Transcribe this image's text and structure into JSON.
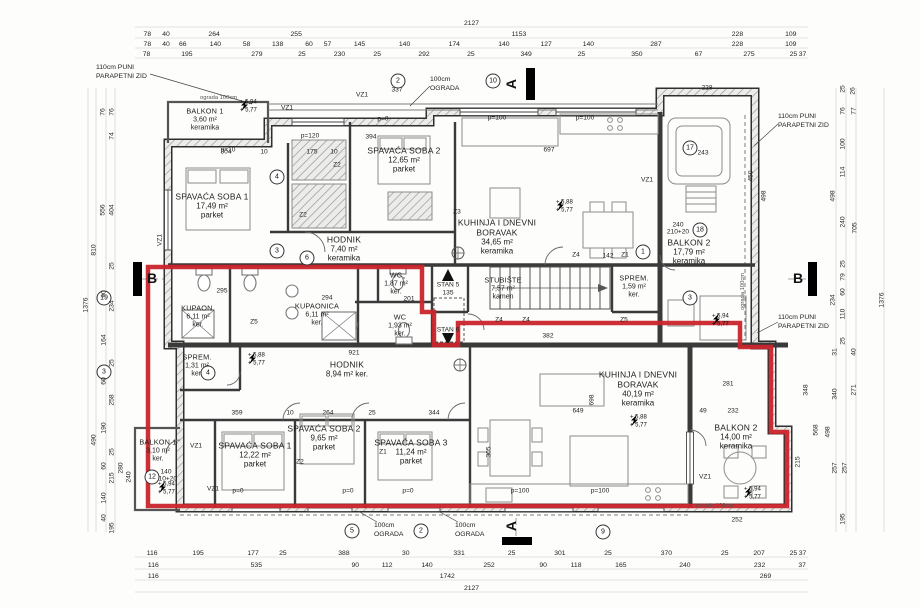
{
  "colors": {
    "boundary_red": "#c9252b",
    "wall": "#2f2f2f",
    "dim_text": "#222222"
  },
  "section_markers": {
    "top": "A",
    "bottom": "A",
    "left": "B",
    "right": "B"
  },
  "rooms": [
    {
      "name": "BALKON 1",
      "area": "3,60 m²",
      "floor": "keramika",
      "x": 205,
      "y": 120,
      "sm": true
    },
    {
      "name": "SPAVAĆA SOBA 1",
      "area": "17,49 m²",
      "floor": "parket",
      "x": 212,
      "y": 206
    },
    {
      "name": "SPAVAĆA SOBA 2",
      "area": "12,65 m²",
      "floor": "parket",
      "x": 404,
      "y": 160
    },
    {
      "name": "HODNIK",
      "area": "7,40 m²",
      "floor": "keramika",
      "x": 344,
      "y": 249
    },
    {
      "name": "KUHINJA I DNEVNI BORAVAK",
      "area": "34,65 m²",
      "floor": "keramika",
      "x": 497,
      "y": 237
    },
    {
      "name": "WC",
      "area": "1,87 m²",
      "floor": "ker.",
      "x": 396,
      "y": 284,
      "sm": true
    },
    {
      "name": "STUBIŠTE",
      "area": "7,57 m²",
      "floor": "kamen",
      "x": 503,
      "y": 289,
      "sm": true
    },
    {
      "name": "SPREM.",
      "area": "1,59 m²",
      "floor": "ker.",
      "x": 634,
      "y": 287,
      "sm": true
    },
    {
      "name": "BALKON 2",
      "area": "17,79 m²",
      "floor": "keramika",
      "x": 689,
      "y": 252
    },
    {
      "name": "KUPAON.",
      "area": "6,11 m²",
      "floor": "ker.",
      "x": 198,
      "y": 317,
      "sm": true
    },
    {
      "name": "KUPAONICA",
      "area": "6,11 m²",
      "floor": "ker.",
      "x": 317,
      "y": 315,
      "sm": true
    },
    {
      "name": "WC",
      "area": "1,93 m²",
      "floor": "ker.",
      "x": 400,
      "y": 326,
      "sm": true
    },
    {
      "name": "SPREM.",
      "area": "1,31 m²",
      "floor": "ker.",
      "x": 197,
      "y": 366,
      "sm": true
    },
    {
      "name": "HODNIK",
      "area": "8,94 m² ker.",
      "floor": "",
      "x": 347,
      "y": 369
    },
    {
      "name": "BALKON 1",
      "area": "3,10 m²",
      "floor": "ker.",
      "x": 158,
      "y": 451,
      "sm": true
    },
    {
      "name": "SPAVAĆA SOBA 1",
      "area": "12,22 m²",
      "floor": "parket",
      "x": 255,
      "y": 455
    },
    {
      "name": "SPAVAĆA SOBA 2",
      "area": "9,65 m²",
      "floor": "parket",
      "x": 324,
      "y": 438
    },
    {
      "name": "SPAVAĆA SOBA 3",
      "area": "11,24 m²",
      "floor": "parket",
      "x": 411,
      "y": 452
    },
    {
      "name": "KUHINJA I DNEVNI BORAVAK",
      "area": "40,19 m²",
      "floor": "keramika",
      "x": 638,
      "y": 389
    },
    {
      "name": "BALKON 2",
      "area": "14,00 m²",
      "floor": "keramika",
      "x": 736,
      "y": 437
    }
  ],
  "levels": [
    {
      "l": "+ 5,94\n+ 5,77",
      "x": 240,
      "y": 107
    },
    {
      "l": "+ 5,88\n+ 5,77",
      "x": 556,
      "y": 207
    },
    {
      "l": "+ 5,94\n+ 5,77",
      "x": 712,
      "y": 321
    },
    {
      "l": "+ 5,88\n+ 5,77",
      "x": 248,
      "y": 360
    },
    {
      "l": "+ 5,88\n+ 5,77",
      "x": 630,
      "y": 422
    },
    {
      "l": "+ 5,94\n+ 5,77",
      "x": 158,
      "y": 489
    },
    {
      "l": "+ 5,94\n+ 5,77",
      "x": 744,
      "y": 494
    }
  ],
  "annotations": [
    {
      "t": "110cm PUNI\nPARAPETNI ZID",
      "x": 96,
      "y": 64
    },
    {
      "t": "110cm PUNI\nPARAPETNI ZID",
      "x": 778,
      "y": 113
    },
    {
      "t": "110cm PUNI\nPARAPETNI ZID",
      "x": 778,
      "y": 314
    },
    {
      "t": "100cm\nOGRADA",
      "x": 430,
      "y": 76
    },
    {
      "t": "100cm\nOGRADA",
      "x": 374,
      "y": 522
    },
    {
      "t": "100cm\nOGRADA",
      "x": 455,
      "y": 522
    },
    {
      "t": "ograda 100cm",
      "x": 200,
      "y": 95,
      "cls": "t"
    },
    {
      "t": "ograda 100cm",
      "x": 696,
      "y": 503,
      "cls": "t"
    },
    {
      "t": "ograda 100cm",
      "x": 740,
      "y": 310,
      "cls": "t r"
    }
  ],
  "plan_labels": [
    {
      "t": "337",
      "x": 397,
      "y": 90
    },
    {
      "t": "304",
      "x": 226,
      "y": 152
    },
    {
      "t": "175",
      "x": 312,
      "y": 152
    },
    {
      "t": "10",
      "x": 264,
      "y": 152
    },
    {
      "t": "10",
      "x": 334,
      "y": 152
    },
    {
      "t": "394",
      "x": 371,
      "y": 137
    },
    {
      "t": "p=120",
      "x": 310,
      "y": 136
    },
    {
      "t": "p=10",
      "x": 228,
      "y": 150
    },
    {
      "t": "p=0",
      "x": 383,
      "y": 119
    },
    {
      "t": "p=100",
      "x": 497,
      "y": 118
    },
    {
      "t": "p=100",
      "x": 585,
      "y": 118
    },
    {
      "t": "697",
      "x": 549,
      "y": 150
    },
    {
      "t": "243",
      "x": 703,
      "y": 153
    },
    {
      "t": "450",
      "x": 751,
      "y": 176,
      "r": true
    },
    {
      "t": "498",
      "x": 764,
      "y": 196,
      "r": true
    },
    {
      "t": "228",
      "x": 707,
      "y": 88
    },
    {
      "t": "295",
      "x": 222,
      "y": 291
    },
    {
      "t": "294",
      "x": 327,
      "y": 298
    },
    {
      "t": "201",
      "x": 409,
      "y": 299
    },
    {
      "t": "921",
      "x": 354,
      "y": 353
    },
    {
      "t": "STAN 5",
      "x": 448,
      "y": 285
    },
    {
      "t": "135",
      "x": 448,
      "y": 293
    },
    {
      "t": "STAN 6",
      "x": 448,
      "y": 330
    },
    {
      "t": "142",
      "x": 608,
      "y": 256
    },
    {
      "t": "382",
      "x": 548,
      "y": 336
    },
    {
      "t": "359",
      "x": 237,
      "y": 413
    },
    {
      "t": "10",
      "x": 290,
      "y": 413
    },
    {
      "t": "264",
      "x": 328,
      "y": 413
    },
    {
      "t": "25",
      "x": 372,
      "y": 413
    },
    {
      "t": "344",
      "x": 434,
      "y": 413
    },
    {
      "t": "649",
      "x": 578,
      "y": 411
    },
    {
      "t": "698",
      "x": 592,
      "y": 400,
      "r": true
    },
    {
      "t": "305",
      "x": 489,
      "y": 452,
      "r": true
    },
    {
      "t": "232",
      "x": 733,
      "y": 411
    },
    {
      "t": "49",
      "x": 703,
      "y": 411
    },
    {
      "t": "281",
      "x": 728,
      "y": 384
    },
    {
      "t": "252",
      "x": 737,
      "y": 520
    },
    {
      "t": "p=0",
      "x": 238,
      "y": 491
    },
    {
      "t": "p=0",
      "x": 348,
      "y": 491
    },
    {
      "t": "p=0",
      "x": 408,
      "y": 491
    },
    {
      "t": "p=100",
      "x": 520,
      "y": 491
    },
    {
      "t": "p=100",
      "x": 600,
      "y": 491
    },
    {
      "t": "240",
      "x": 678,
      "y": 225
    },
    {
      "t": "210+20",
      "x": 678,
      "y": 232
    },
    {
      "t": "140",
      "x": 166,
      "y": 472
    },
    {
      "t": "210+20",
      "x": 166,
      "y": 479
    },
    {
      "t": "VZ1",
      "x": 362,
      "y": 95
    },
    {
      "t": "VZ1",
      "x": 287,
      "y": 108
    },
    {
      "t": "VZ1",
      "x": 647,
      "y": 180
    },
    {
      "t": "VZ1",
      "x": 196,
      "y": 446
    },
    {
      "t": "VZ1",
      "x": 213,
      "y": 489
    },
    {
      "t": "VZ1",
      "x": 705,
      "y": 477
    },
    {
      "t": "VZ1",
      "x": 160,
      "y": 240,
      "r": true
    },
    {
      "t": "Z2",
      "x": 337,
      "y": 165
    },
    {
      "t": "Z2",
      "x": 303,
      "y": 215
    },
    {
      "t": "Z3",
      "x": 457,
      "y": 212
    },
    {
      "t": "Z1",
      "x": 625,
      "y": 255
    },
    {
      "t": "Z4",
      "x": 576,
      "y": 255
    },
    {
      "t": "Z4",
      "x": 499,
      "y": 320
    },
    {
      "t": "Z4",
      "x": 526,
      "y": 320
    },
    {
      "t": "Z5",
      "x": 624,
      "y": 320
    },
    {
      "t": "Z5",
      "x": 254,
      "y": 322
    },
    {
      "t": "Z2",
      "x": 300,
      "y": 462
    },
    {
      "t": "Z1",
      "x": 383,
      "y": 452
    }
  ],
  "circles": [
    {
      "n": "4",
      "x": 277,
      "y": 177
    },
    {
      "n": "3",
      "x": 277,
      "y": 251
    },
    {
      "n": "6",
      "x": 307,
      "y": 258
    },
    {
      "n": "2",
      "x": 398,
      "y": 81
    },
    {
      "n": "10",
      "x": 493,
      "y": 81
    },
    {
      "n": "17",
      "x": 690,
      "y": 148
    },
    {
      "n": "18",
      "x": 700,
      "y": 230
    },
    {
      "n": "1",
      "x": 643,
      "y": 252
    },
    {
      "n": "3",
      "x": 690,
      "y": 298
    },
    {
      "n": "19",
      "x": 104,
      "y": 298
    },
    {
      "n": "3",
      "x": 104,
      "y": 372
    },
    {
      "n": "4",
      "x": 208,
      "y": 373
    },
    {
      "n": "12",
      "x": 152,
      "y": 477
    },
    {
      "n": "5",
      "x": 352,
      "y": 531
    },
    {
      "n": "2",
      "x": 421,
      "y": 531
    },
    {
      "n": "9",
      "x": 603,
      "y": 532
    }
  ],
  "dims": {
    "top_rows": [
      {
        "y": 24,
        "v": [
          "2127"
        ]
      },
      {
        "y": 35,
        "v": [
          "78",
          "40",
          "264",
          "255",
          "1153",
          "228",
          "109"
        ]
      },
      {
        "y": 45,
        "v": [
          "78",
          "40",
          "66",
          "140",
          "58",
          "138",
          "60",
          "57",
          "145",
          "140",
          "174",
          "140",
          "127",
          "140",
          "287",
          "228",
          "109"
        ]
      },
      {
        "y": 55,
        "v": [
          "78",
          "195",
          "279",
          "25",
          "230",
          "25",
          "292",
          "25",
          "349",
          "25",
          "350",
          "67",
          "275",
          "25",
          "37"
        ]
      }
    ],
    "bottom_rows": [
      {
        "y": 554,
        "v": [
          "116",
          "195",
          "177",
          "25",
          "388",
          "30",
          "331",
          "25",
          "301",
          "25",
          "370",
          "25",
          "207",
          "25",
          "37"
        ]
      },
      {
        "y": 566,
        "v": [
          "116",
          "535",
          "90",
          "112",
          "140",
          "252",
          "90",
          "118",
          "165",
          "240",
          "232",
          "37"
        ]
      },
      {
        "y": 577,
        "v": [
          "116",
          "1742",
          "269"
        ]
      },
      {
        "y": 589,
        "v": [
          "2127"
        ]
      }
    ],
    "left": [
      {
        "t": "76",
        "x": 103,
        "y": 112
      },
      {
        "t": "76",
        "x": 112,
        "y": 112
      },
      {
        "t": "74",
        "x": 112,
        "y": 136
      },
      {
        "t": "556",
        "x": 103,
        "y": 210
      },
      {
        "t": "404",
        "x": 112,
        "y": 210
      },
      {
        "t": "810",
        "x": 94,
        "y": 250
      },
      {
        "t": "1376",
        "x": 86,
        "y": 305
      },
      {
        "t": "25",
        "x": 112,
        "y": 266
      },
      {
        "t": "90",
        "x": 104,
        "y": 294
      },
      {
        "t": "234",
        "x": 112,
        "y": 306
      },
      {
        "t": "164",
        "x": 104,
        "y": 340
      },
      {
        "t": "25",
        "x": 112,
        "y": 363
      },
      {
        "t": "60",
        "x": 104,
        "y": 381
      },
      {
        "t": "258",
        "x": 112,
        "y": 400
      },
      {
        "t": "190",
        "x": 104,
        "y": 428
      },
      {
        "t": "490",
        "x": 94,
        "y": 440
      },
      {
        "t": "25",
        "x": 112,
        "y": 452
      },
      {
        "t": "60",
        "x": 104,
        "y": 466
      },
      {
        "t": "215",
        "x": 112,
        "y": 478
      },
      {
        "t": "280",
        "x": 121,
        "y": 468
      },
      {
        "t": "240",
        "x": 129,
        "y": 477
      },
      {
        "t": "140",
        "x": 104,
        "y": 498
      },
      {
        "t": "40",
        "x": 104,
        "y": 518
      },
      {
        "t": "195",
        "x": 112,
        "y": 528
      }
    ],
    "right": [
      {
        "t": "25",
        "x": 843,
        "y": 89
      },
      {
        "t": "26",
        "x": 853,
        "y": 91
      },
      {
        "t": "76",
        "x": 843,
        "y": 111
      },
      {
        "t": "77",
        "x": 854,
        "y": 111
      },
      {
        "t": "100",
        "x": 843,
        "y": 144
      },
      {
        "t": "114",
        "x": 843,
        "y": 172
      },
      {
        "t": "498",
        "x": 833,
        "y": 196
      },
      {
        "t": "240",
        "x": 843,
        "y": 222
      },
      {
        "t": "705",
        "x": 855,
        "y": 228
      },
      {
        "t": "1376",
        "x": 882,
        "y": 300
      },
      {
        "t": "25",
        "x": 843,
        "y": 264
      },
      {
        "t": "79",
        "x": 843,
        "y": 277
      },
      {
        "t": "60",
        "x": 843,
        "y": 292
      },
      {
        "t": "234",
        "x": 833,
        "y": 300
      },
      {
        "t": "110",
        "x": 843,
        "y": 314
      },
      {
        "t": "25",
        "x": 843,
        "y": 341
      },
      {
        "t": "31",
        "x": 835,
        "y": 352
      },
      {
        "t": "40",
        "x": 854,
        "y": 352
      },
      {
        "t": "340",
        "x": 835,
        "y": 394
      },
      {
        "t": "271",
        "x": 854,
        "y": 390
      },
      {
        "t": "498",
        "x": 828,
        "y": 432
      },
      {
        "t": "568",
        "x": 816,
        "y": 430
      },
      {
        "t": "348",
        "x": 806,
        "y": 390
      },
      {
        "t": "215",
        "x": 798,
        "y": 462
      },
      {
        "t": "257",
        "x": 835,
        "y": 468
      },
      {
        "t": "257",
        "x": 845,
        "y": 468
      },
      {
        "t": "195",
        "x": 843,
        "y": 519
      }
    ]
  }
}
